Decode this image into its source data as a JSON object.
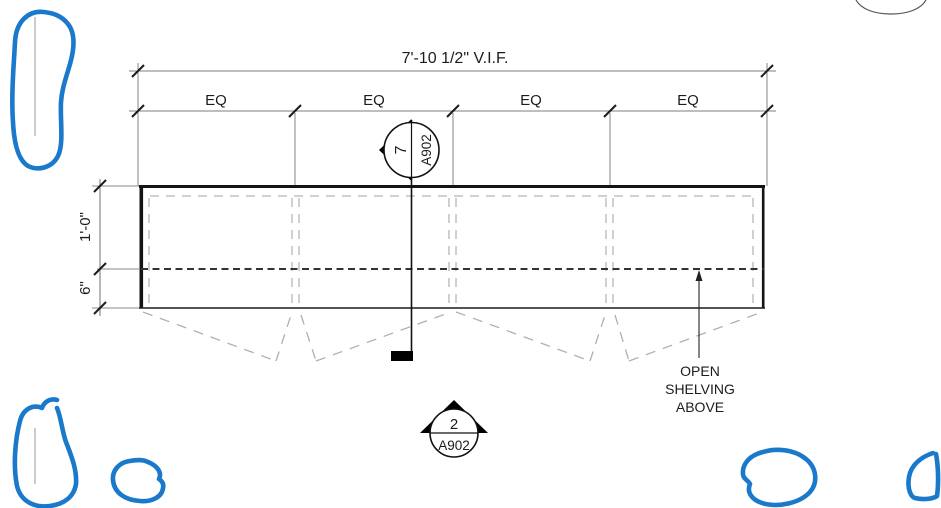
{
  "drawing": {
    "overall_dim_label": "7'-10 1/2\" V.I.F.",
    "eq_labels": [
      "EQ",
      "EQ",
      "EQ",
      "EQ"
    ],
    "left_dims": {
      "upper": "1'-0\"",
      "lower": "6\""
    },
    "callouts": {
      "section_top": {
        "number": "7",
        "sheet": "A902"
      },
      "section_bottom": {
        "number": "2",
        "sheet": "A902"
      }
    },
    "notes": {
      "open_shelving": [
        "OPEN",
        "SHELVING",
        "ABOVE"
      ]
    }
  },
  "colors": {
    "markup_blue": "#1a79ca",
    "line_black": "#1b1b1b",
    "dim_gray": "#7d7d7d",
    "hidden_dash_light": "#b5b5b5",
    "hidden_dash_dark": "#333333"
  }
}
